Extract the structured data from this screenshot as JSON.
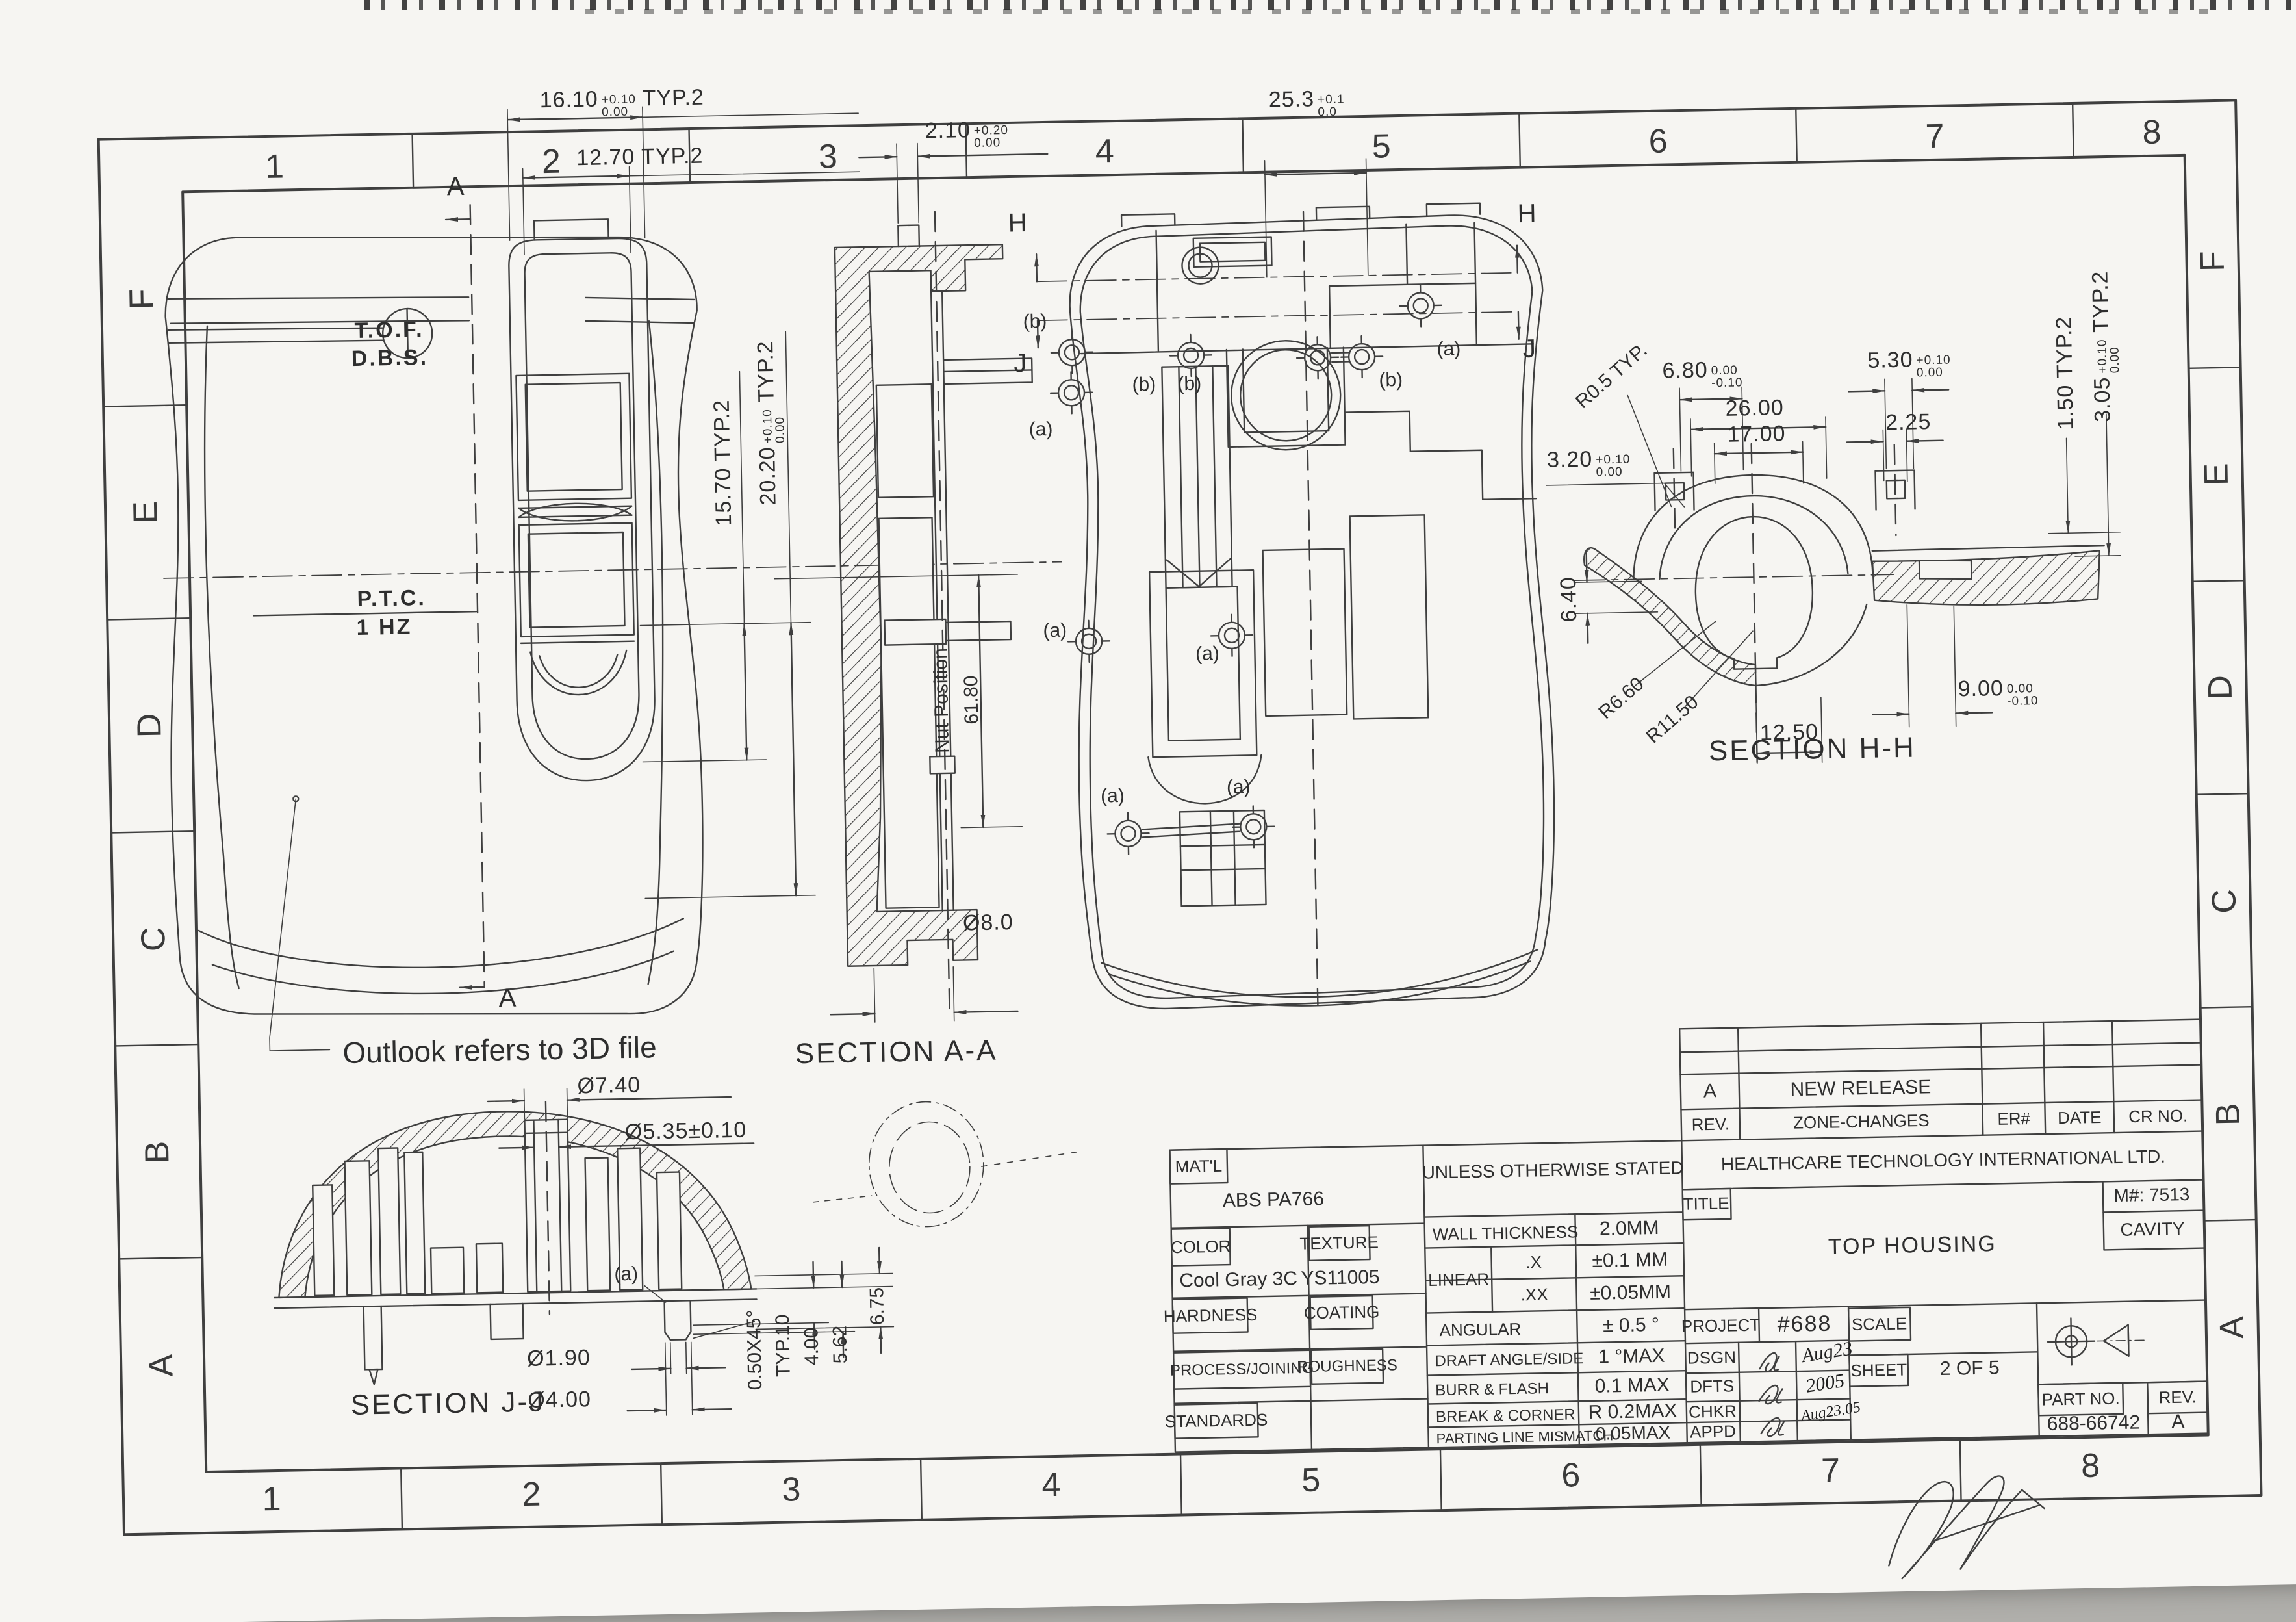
{
  "grid": {
    "top": [
      "1",
      "2",
      "3",
      "4",
      "5",
      "6",
      "7",
      "8"
    ],
    "bottom": [
      "1",
      "2",
      "3",
      "4",
      "5",
      "6",
      "7",
      "8"
    ],
    "left": [
      "F",
      "E",
      "D",
      "C",
      "B",
      "A"
    ],
    "right": [
      "F",
      "E",
      "D",
      "C",
      "B",
      "A"
    ]
  },
  "front_view": {
    "dim_16_10": {
      "v": "16.10",
      "up": "+0.10",
      "dn": "0.00",
      "suf": "TYP.2"
    },
    "dim_12_70": "12.70 TYP.2",
    "dim_15_70": "15.70 TYP.2",
    "dim_20_20": {
      "v": "20.20",
      "up": "+0.10",
      "dn": "0.00",
      "suf": "TYP.2"
    },
    "section_arrow": "A",
    "tof": "T.O.F.",
    "dbs": "D.B.S.",
    "ptc": "P.T.C.",
    "hz": "1 HZ",
    "outlook_note": "Outlook refers to 3D file"
  },
  "section_aa": {
    "title": "SECTION A-A",
    "dim_2_10": {
      "v": "2.10",
      "up": "+0.20",
      "dn": "0.00"
    },
    "nut_position": "Nut Position",
    "dim_61_80": "61.80",
    "dim_dia_8": "Ø8.0"
  },
  "back_view": {
    "dim_25_3": {
      "v": "25.3",
      "up": "+0.1",
      "dn": "0.0"
    },
    "h_label": "H",
    "j_label": "J",
    "marker_a": "(a)",
    "marker_b": "(b)"
  },
  "section_hh": {
    "title": "SECTION H-H",
    "r0_5": "R0.5 TYP.",
    "dim_3_20": {
      "v": "3.20",
      "up": "+0.10",
      "dn": "0.00"
    },
    "dim_6_80": {
      "v": "6.80",
      "up": "0.00",
      "dn": "-0.10"
    },
    "dim_26": "26.00",
    "dim_17": "17.00",
    "dim_5_30": {
      "v": "5.30",
      "up": "+0.10",
      "dn": "0.00"
    },
    "dim_2_25": "2.25",
    "dim_1_50": "1.50 TYP.2",
    "dim_3_05": {
      "v": "3.05",
      "up": "+0.10",
      "dn": "0.00",
      "suf": "TYP.2"
    },
    "dim_6_40": "6.40",
    "r6_60": "R6.60",
    "r11_50": "R11.50",
    "dim_9_00": {
      "v": "9.00",
      "up": "0.00",
      "dn": "-0.10"
    },
    "dim_12_50": "12.50"
  },
  "section_jj": {
    "title": "SECTION J-J",
    "dia_7_40": "Ø7.40",
    "dia_5_35": "Ø5.35±0.10",
    "marker_a": "(a)",
    "dia_1_90": "Ø1.90",
    "dia_4_00": "Ø4.00",
    "chamfer_1": "0.50X45°",
    "chamfer_2": "TYP.10",
    "dim_4_00": "4.00",
    "dim_5_62": "5.62",
    "dim_6_75": "6.75"
  },
  "revision_table": {
    "rev_value": "A",
    "change_value": "NEW RELEASE",
    "col_rev": "REV.",
    "col_zone": "ZONE-CHANGES",
    "col_er": "ER#",
    "col_date": "DATE",
    "col_cr": "CR NO."
  },
  "title_block": {
    "mat_label": "MAT'L",
    "mat_value": "ABS PA766",
    "uos": "UNLESS OTHERWISE STATED",
    "company": "HEALTHCARE TECHNOLOGY INTERNATIONAL LTD.",
    "color_label": "COLOR",
    "texture_label": "TEXTURE",
    "color_value": "Cool Gray 3C",
    "texture_value": "YS11005",
    "hardness_label": "HARDNESS",
    "coating_label": "COATING",
    "process_label": "PROCESS/JOINING",
    "roughness_label": "ROUGHNESS",
    "standards_label": "STANDARDS",
    "wall_label": "WALL THICKNESS",
    "wall_value": "2.0MM",
    "linear_label": "LINEAR",
    "x_label": ".X",
    "x_value": "±0.1 MM",
    "xx_label": ".XX",
    "xx_value": "±0.05MM",
    "angular_label": "ANGULAR",
    "angular_value": "± 0.5 °",
    "draft_label": "DRAFT ANGLE/SIDE",
    "draft_value": "1 °MAX",
    "burr_label": "BURR & FLASH",
    "burr_value": "0.1 MAX",
    "break_label": "BREAK & CORNER",
    "break_value": "R 0.2MAX",
    "parting_label": "PARTING LINE MISMATCH",
    "parting_value": "0.05MAX",
    "title_label": "TITLE",
    "title_value": "TOP HOUSING",
    "m_number": "M#: 7513",
    "cavity": "CAVITY",
    "project_label": "PROJECT",
    "project_value": "#688",
    "scale_label": "SCALE",
    "sheet_label": "SHEET",
    "sheet_value": "2 OF 5",
    "dsgn_label": "DSGN",
    "dfts_label": "DFTS",
    "chkr_label": "CHKR",
    "appd_label": "APPD",
    "dsgn_date": "Aug23",
    "dfts_date": "2005",
    "chkr_date": "Aug23.05",
    "part_label": "PART NO.",
    "part_value": "688-66742",
    "rev_label": "REV.",
    "rev_value": "A"
  }
}
